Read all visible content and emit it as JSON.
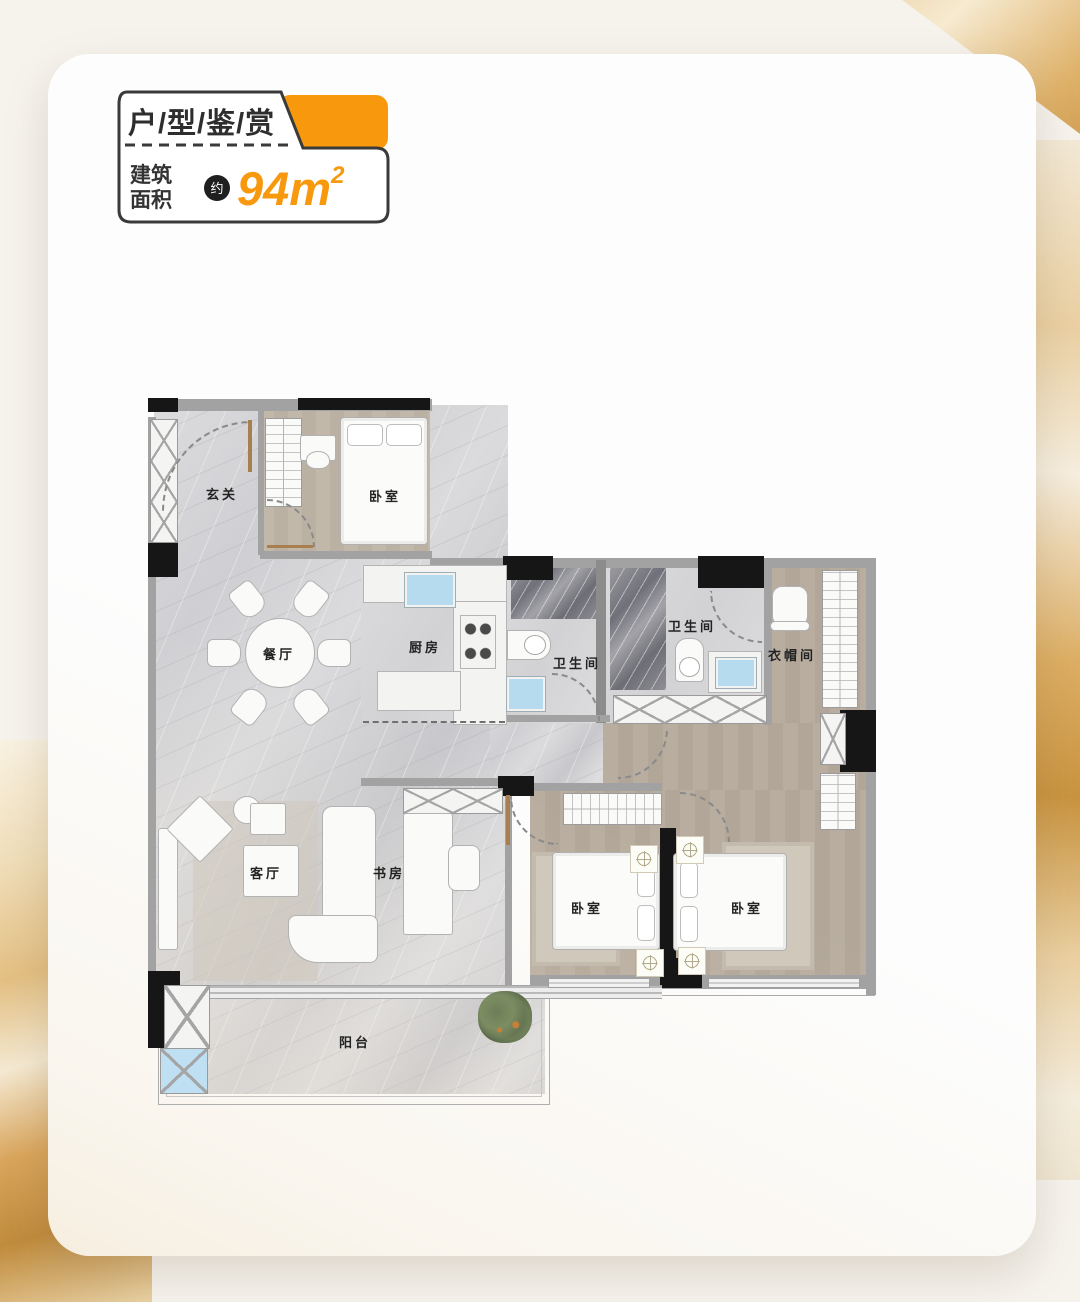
{
  "header": {
    "title": "户/型/鉴/赏",
    "area_label_line1": "建筑",
    "area_label_line2": "面积",
    "approx_badge": "约",
    "area_value": "94m",
    "area_superscript": "2"
  },
  "floorplan": {
    "rooms": {
      "entrance": {
        "label": "玄关"
      },
      "bedroom_top": {
        "label": "卧室"
      },
      "dining": {
        "label": "餐厅"
      },
      "kitchen": {
        "label": "厨房"
      },
      "bathroom_1": {
        "label": "卫生间"
      },
      "bathroom_2": {
        "label": "卫生间"
      },
      "cloakroom": {
        "label": "衣帽间"
      },
      "living": {
        "label": "客厅"
      },
      "study": {
        "label": "书房"
      },
      "bedroom_left": {
        "label": "卧室"
      },
      "bedroom_right": {
        "label": "卧室"
      },
      "balcony": {
        "label": "阳台"
      }
    }
  },
  "colors": {
    "accent_orange": "#F8990D",
    "sink_blue": "#B7DBEE",
    "wall_black": "#161616",
    "wall_gray": "#A2A2A2"
  }
}
